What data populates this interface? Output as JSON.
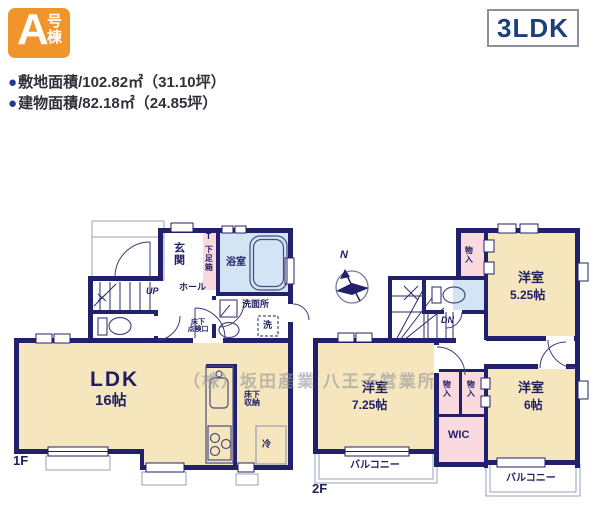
{
  "header": {
    "badge": {
      "letter": "A",
      "suffix": "号棟",
      "color": "#f0952b"
    },
    "plan_type": "3LDK",
    "site_area": {
      "bullet": "●",
      "text": "敷地面積/102.82㎡（31.10坪）"
    },
    "building_area": {
      "bullet": "●",
      "text": "建物面積/82.18㎡（24.85坪）"
    }
  },
  "watermark": "（株）坂田産業 八王子営業所",
  "compass_label": "N",
  "floor1": {
    "floor_label": "1F",
    "rooms": {
      "genkan": "玄関",
      "shoebox_top": "T",
      "shoebox": "下足箱",
      "bathroom": "浴室",
      "hall": "ホール",
      "stairs_up": "UP",
      "washroom": "洗面所",
      "washer": "洗",
      "underfloor_access_line1": "床下",
      "underfloor_access_line2": "点検口",
      "ldk_name": "LDK",
      "ldk_size": "16帖",
      "underfloor_storage_line1": "床下",
      "underfloor_storage_line2": "収納",
      "fridge": "冷"
    }
  },
  "floor2": {
    "floor_label": "2F",
    "rooms": {
      "closet_top": "物入",
      "bedroom1_name": "洋室",
      "bedroom1_size": "5.25帖",
      "stairs_down": "DN",
      "bedroom2_name": "洋室",
      "bedroom2_size": "7.25帖",
      "closet_a": "物入",
      "closet_b": "物入",
      "wic": "WIC",
      "bedroom3_name": "洋室",
      "bedroom3_size": "6帖",
      "balcony_left": "バルコニー",
      "balcony_right": "バルコニー"
    }
  },
  "colors": {
    "wall": "#20216a",
    "room_cream": "#f6e6bd",
    "closet_pink": "#fadadf",
    "bath_blue": "#d3e5f4",
    "badge_orange": "#f0952b",
    "plan_type_navy": "#1c3f7e"
  }
}
